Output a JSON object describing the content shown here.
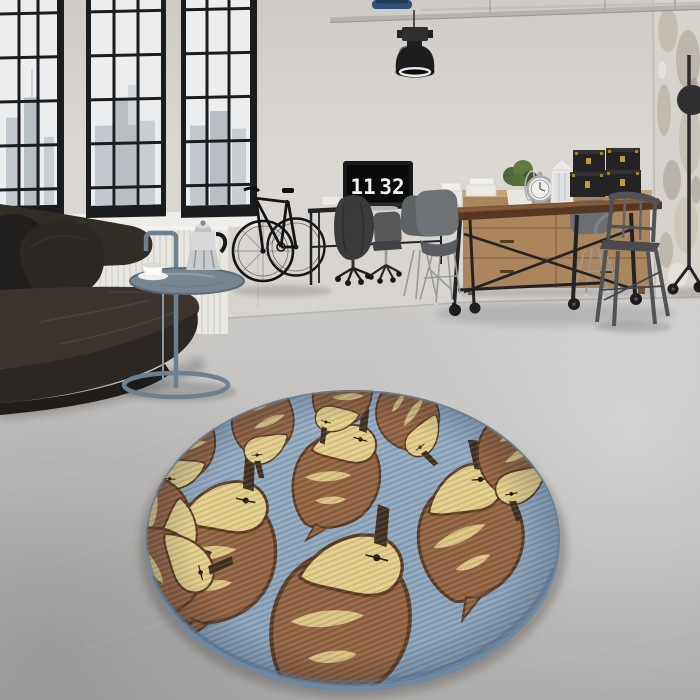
{
  "meta": {
    "title": "Industrial loft interior photograph",
    "subject": "Round blue rug with duck pattern in a concrete-floor loft living room"
  },
  "clock": {
    "hours": "11",
    "minutes": "32"
  },
  "rug": {
    "shape": "round",
    "pattern": "ducks",
    "duck_count": 11
  },
  "objects": [
    "factory windows with city view",
    "white radiator",
    "leather chaise sofa",
    "black cushions",
    "round tray side table",
    "moka pot",
    "coffee cup",
    "black bicycle",
    "industrial pendant lamp",
    "ceiling pipes",
    "desk with monitor showing flip clock",
    "office chair with jacket",
    "wooden sideboard",
    "potted plant",
    "decorative clock",
    "white lantern",
    "black storage trunks",
    "industrial wood dining table",
    "shell chairs",
    "metal cafe chair",
    "rolling stand",
    "distressed plaster column",
    "round duck-pattern rug",
    "polished concrete floor"
  ],
  "colors": {
    "wall": "#d7d4d0",
    "wall_top": "#cfccc8",
    "window_frame": "#1b1c1e",
    "glass": "#ecedee",
    "skyline": "#c2c8cd",
    "skyline_far": "#d3d7da",
    "sill": "#efede9",
    "radiator": "#e9e7e2",
    "radiator_fin": "#d3d0cb",
    "floor_near": "#b1afad",
    "floor_far": "#cbc9c7",
    "floor_line": "#b4b1ad",
    "column_base": "#d6d2cc",
    "column_patch_dark": "#a89f92",
    "column_patch_mid": "#c3bcb0",
    "column_patch_light": "#e6e2dc",
    "pipe": "#b5b3b0",
    "pipe_fitting": "#30507a",
    "lamp": "#1d1d1f",
    "lamp_inner": "#e8e8e8",
    "sofa_seat": "#3b342e",
    "sofa_front": "#2c2722",
    "sofa_back": "#332d28",
    "sofa_base": "#201c19",
    "pillow_dark": "#211f1d",
    "pillow": "#2b2825",
    "leather_highlight": "#4f4740",
    "table_blue": "#6c8090",
    "tray": "#76858f",
    "tray_streak": "#93a1aa",
    "moka_body": "#c9cacc",
    "moka_dark": "#8e9093",
    "cup": "#f1efec",
    "bike": "#141416",
    "desk": "#191a1c",
    "monitor_bezel": "#17181a",
    "screen": "#0a0a0b",
    "clock_digits": "#f2f2f2",
    "monitor_stand": "#a7a9ab",
    "jacket": "#3b3b3d",
    "office_chair": "#56585a",
    "chrome": "#97999b",
    "paper": "#eceae6",
    "sideboard": "#ab855b",
    "sideboard_top": "#c5a378",
    "sideboard_line": "#8a6844",
    "plant": "#50693b",
    "plant_dark": "#3e5330",
    "pot": "#e9e7e3",
    "decor_silver": "#b2b4b6",
    "lantern": "#eceae6",
    "box": "#232326",
    "box_top": "#313136",
    "brass": "#c19a39",
    "table_wood": "#7d5635",
    "table_wood_edge": "#553722",
    "metal_black": "#232325",
    "shell_chair": "#6e7274",
    "shell_chair_dark": "#5f6365",
    "tolix": "#515256",
    "tolix_light": "#7e8086",
    "stand_black": "#2b2b2d",
    "rug_base": "#8ba3ba",
    "rug_base_light": "#93abc2",
    "rug_side": "#7089a2",
    "rug_rim": "#647e97",
    "duck_body": "#91603d",
    "duck_head": "#e3cc87",
    "duck_beak": "#3f2d1c",
    "duck_outline": "#5a3a21",
    "shadow": "#3c3a38"
  }
}
